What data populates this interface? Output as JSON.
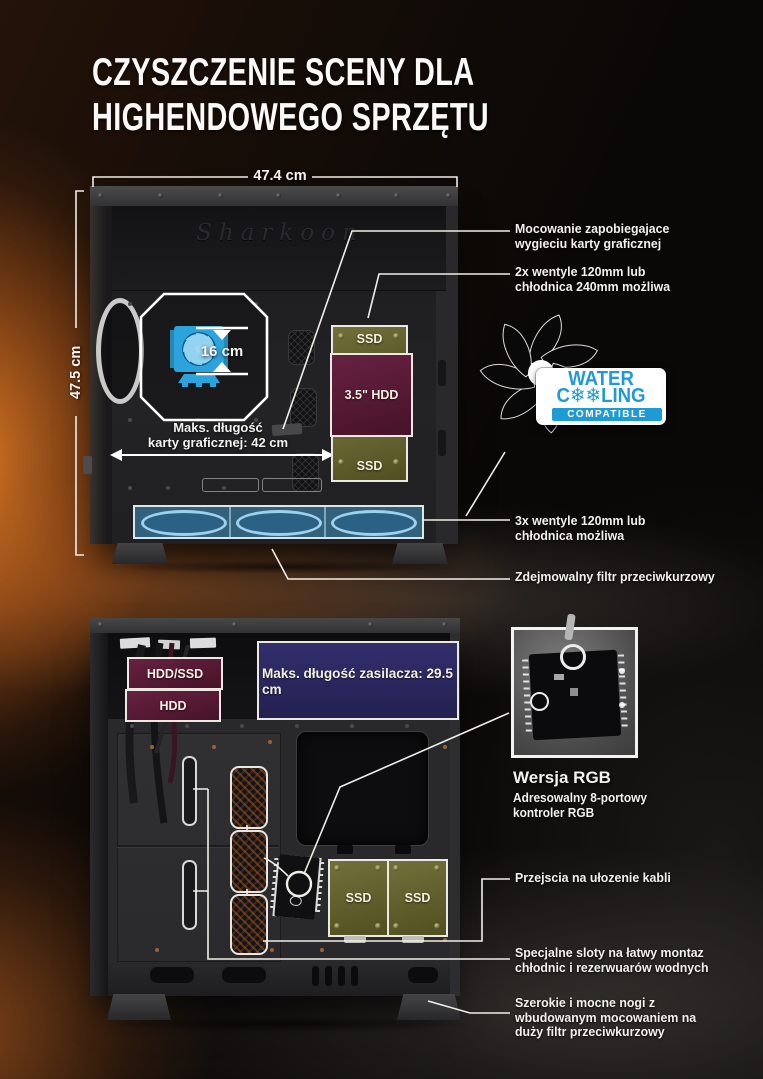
{
  "brand": {
    "name": "Sharkoon"
  },
  "title": {
    "line1": "CZYSZCZENIE SCENY DLA",
    "line2": "HIGHENDOWEGO SPRZĘTU"
  },
  "colors": {
    "accent_blue": "#2ba3dc",
    "badge_blue": "#1e9ad6",
    "maroon": "#5d1c38",
    "olive": "#67662e",
    "navy": "#2b2961",
    "annotation_line": "#f1eee8"
  },
  "top_case": {
    "width_label": "47.4 cm",
    "height_label": "47.5 cm",
    "cpu_clearance_label": "16 cm",
    "gpu_length_label": "Maks. długość\nkarty graficznej: 42 cm",
    "drive_bays": {
      "ssd_top": "SSD",
      "hdd": "3.5\" HDD",
      "ssd_bottom": "SSD"
    }
  },
  "water_badge": {
    "water": "WATER",
    "cooling": "C❄❄LING",
    "compatible": "COMPATIBLE"
  },
  "annotations_top": [
    {
      "text": "Mocowanie zapobiegajace\nwygieciu karty graficznej"
    },
    {
      "text": "2x wentyle 120mm lub\nchłodnica 240mm możliwa"
    },
    {
      "text": "3x wentyle 120mm lub\nchłodnica możliwa"
    },
    {
      "text": "Zdejmowalny filtr przeciwkurzowy"
    }
  ],
  "bottom_case": {
    "bay_labels": {
      "hdd_ssd": "HDD/SSD",
      "hdd": "HDD"
    },
    "psu_length_label": "Maks. długość zasilacza: 29.5 cm",
    "ssd_left": "SSD",
    "ssd_right": "SSD"
  },
  "rgb_section": {
    "title": "Wersja RGB",
    "subtitle": "Adresowalny 8-portowy\nkontroler RGB"
  },
  "annotations_bottom": [
    {
      "text": "Przejscia na ułozenie kabli"
    },
    {
      "text": "Specjalne sloty na łatwy montaz\nchłodnic i rezerwuarów wodnych"
    },
    {
      "text": "Szerokie i mocne nogi z\nwbudowanym mocowaniem na\nduży filtr przeciwkurzowy"
    }
  ]
}
